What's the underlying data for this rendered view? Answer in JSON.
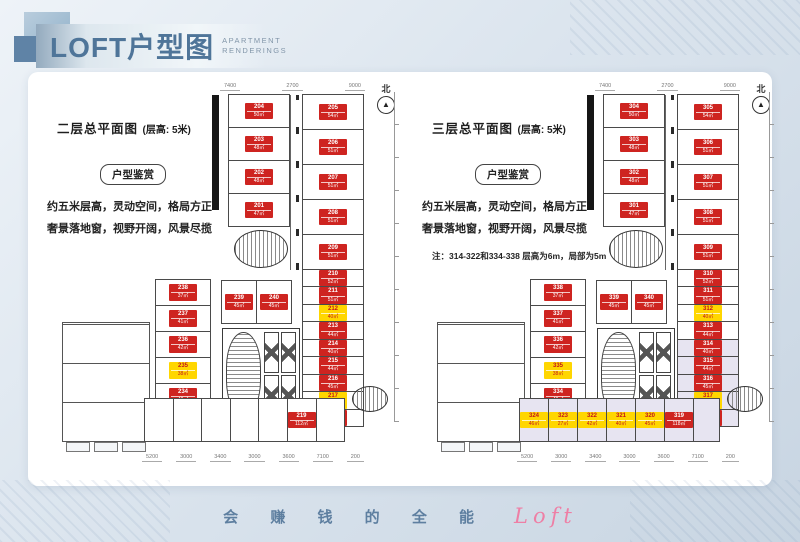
{
  "header": {
    "title_cn": "LOFT户型图",
    "title_en1": "APARTMENT",
    "title_en2": "RENDERINGS"
  },
  "footer": {
    "slogan_cn": "会 赚 钱 的 全 能",
    "slogan_en": "Loft"
  },
  "colors": {
    "unit_red": "#ce2420",
    "unit_yellow": "#ffd600",
    "shaded_room": "#e7e4f1",
    "title_blue": "#4f7599",
    "slogan_pink": "#ee7fa5"
  },
  "plans": [
    {
      "title": "二层总平面图",
      "title_suffix": "(层高: 5米)",
      "badge": "户型鉴赏",
      "desc1": "约五米层高，灵动空间，格局方正",
      "desc2": "奢景落地窗，视野开阔，风景尽揽",
      "note": "",
      "north_label": "北",
      "north_arrow": "▲",
      "dims_top": [
        "7400",
        "2700",
        "9000"
      ],
      "dims_bottom": [
        "5200",
        "3000",
        "3400",
        "3000",
        "3600",
        "7100",
        "200"
      ],
      "groups": {
        "colA": [
          {
            "no": "204",
            "area": "50㎡",
            "c": "red"
          },
          {
            "no": "203",
            "area": "48㎡",
            "c": "red"
          },
          {
            "no": "202",
            "area": "48㎡",
            "c": "red"
          },
          {
            "no": "201",
            "area": "47㎡",
            "c": "red"
          }
        ],
        "colB": [
          {
            "no": "205",
            "area": "54㎡",
            "c": "red"
          },
          {
            "no": "206",
            "area": "51㎡",
            "c": "red"
          },
          {
            "no": "207",
            "area": "51㎡",
            "c": "red"
          },
          {
            "no": "208",
            "area": "51㎡",
            "c": "red"
          },
          {
            "no": "209",
            "area": "51㎡",
            "c": "red"
          }
        ],
        "colR": [
          {
            "no": "210",
            "area": "52㎡",
            "c": "red"
          },
          {
            "no": "211",
            "area": "51㎡",
            "c": "red"
          },
          {
            "no": "212",
            "area": "40㎡",
            "c": "yellow"
          },
          {
            "no": "213",
            "area": "44㎡",
            "c": "red"
          },
          {
            "no": "214",
            "area": "40㎡",
            "c": "red"
          },
          {
            "no": "215",
            "area": "44㎡",
            "c": "red"
          },
          {
            "no": "216",
            "area": "45㎡",
            "c": "red"
          },
          {
            "no": "217",
            "area": "41㎡",
            "c": "yellow"
          },
          {
            "no": "218",
            "area": "44㎡",
            "c": "red"
          }
        ],
        "colL": [
          {
            "no": "238",
            "area": "37㎡",
            "c": "red"
          },
          {
            "no": "237",
            "area": "41㎡",
            "c": "red"
          },
          {
            "no": "236",
            "area": "42㎡",
            "c": "red"
          },
          {
            "no": "235",
            "area": "38㎡",
            "c": "yellow"
          },
          {
            "no": "234",
            "area": "42㎡",
            "c": "red"
          }
        ],
        "mid": [
          {
            "no": "239",
            "area": "45㎡",
            "c": "red"
          },
          {
            "no": "240",
            "area": "45㎡",
            "c": "red"
          }
        ],
        "bottom": [
          {
            "no": "",
            "area": "",
            "c": "none"
          },
          {
            "no": "",
            "area": "",
            "c": "none"
          },
          {
            "no": "",
            "area": "",
            "c": "none"
          },
          {
            "no": "",
            "area": "",
            "c": "none"
          },
          {
            "no": "",
            "area": "",
            "c": "none"
          },
          {
            "no": "219",
            "area": "112㎡",
            "c": "red"
          },
          {
            "no": "",
            "area": "",
            "c": "none"
          }
        ]
      }
    },
    {
      "title": "三层总平面图",
      "title_suffix": "(层高: 5米)",
      "badge": "户型鉴赏",
      "desc1": "约五米层高，灵动空间，格局方正",
      "desc2": "奢景落地窗，视野开阔，风景尽揽",
      "note": "注：314-322和334-338 层高为6m，局部为5m",
      "north_label": "北",
      "north_arrow": "▲",
      "dims_top": [
        "7400",
        "2700",
        "9000"
      ],
      "dims_bottom": [
        "5200",
        "3000",
        "3400",
        "3000",
        "3600",
        "7100",
        "200"
      ],
      "groups": {
        "colA": [
          {
            "no": "304",
            "area": "50㎡",
            "c": "red"
          },
          {
            "no": "303",
            "area": "48㎡",
            "c": "red"
          },
          {
            "no": "302",
            "area": "48㎡",
            "c": "red"
          },
          {
            "no": "301",
            "area": "47㎡",
            "c": "red"
          }
        ],
        "colB": [
          {
            "no": "305",
            "area": "54㎡",
            "c": "red"
          },
          {
            "no": "306",
            "area": "51㎡",
            "c": "red"
          },
          {
            "no": "307",
            "area": "51㎡",
            "c": "red"
          },
          {
            "no": "308",
            "area": "51㎡",
            "c": "red"
          },
          {
            "no": "309",
            "area": "51㎡",
            "c": "red"
          }
        ],
        "colR": [
          {
            "no": "310",
            "area": "52㎡",
            "c": "red"
          },
          {
            "no": "311",
            "area": "51㎡",
            "c": "red"
          },
          {
            "no": "312",
            "area": "40㎡",
            "c": "yellow"
          },
          {
            "no": "313",
            "area": "44㎡",
            "c": "red"
          },
          {
            "no": "314",
            "area": "40㎡",
            "c": "red",
            "shaded": true
          },
          {
            "no": "315",
            "area": "44㎡",
            "c": "red",
            "shaded": true
          },
          {
            "no": "316",
            "area": "45㎡",
            "c": "red",
            "shaded": true
          },
          {
            "no": "317",
            "area": "41㎡",
            "c": "yellow",
            "shaded": true
          },
          {
            "no": "318",
            "area": "44㎡",
            "c": "red",
            "shaded": true
          }
        ],
        "colL": [
          {
            "no": "338",
            "area": "37㎡",
            "c": "red"
          },
          {
            "no": "337",
            "area": "41㎡",
            "c": "red"
          },
          {
            "no": "336",
            "area": "42㎡",
            "c": "red"
          },
          {
            "no": "335",
            "area": "38㎡",
            "c": "yellow"
          },
          {
            "no": "334",
            "area": "42㎡",
            "c": "red"
          }
        ],
        "mid": [
          {
            "no": "339",
            "area": "45㎡",
            "c": "red"
          },
          {
            "no": "340",
            "area": "45㎡",
            "c": "red"
          }
        ],
        "bottom": [
          {
            "no": "324",
            "area": "46㎡",
            "c": "yellow",
            "shaded": true
          },
          {
            "no": "323",
            "area": "27㎡",
            "c": "yellow",
            "shaded": true
          },
          {
            "no": "322",
            "area": "42㎡",
            "c": "yellow",
            "shaded": true
          },
          {
            "no": "321",
            "area": "40㎡",
            "c": "yellow",
            "shaded": true
          },
          {
            "no": "320",
            "area": "45㎡",
            "c": "yellow",
            "shaded": true
          },
          {
            "no": "319",
            "area": "118㎡",
            "c": "red",
            "shaded": true
          },
          {
            "no": "",
            "area": "",
            "c": "none",
            "shaded": true
          }
        ]
      }
    }
  ]
}
